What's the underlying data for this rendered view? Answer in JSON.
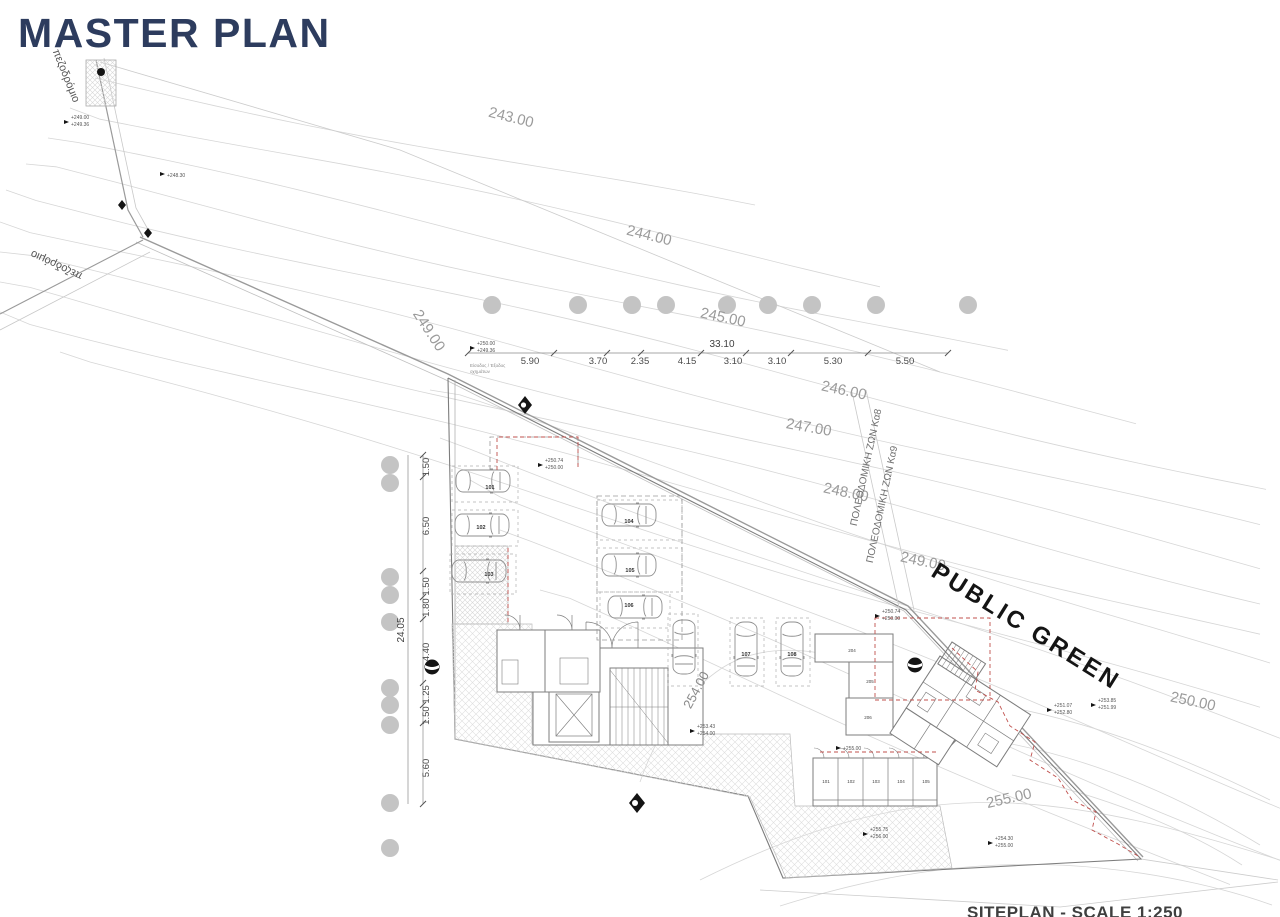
{
  "page": {
    "title": "MASTER PLAN",
    "caption": "SITEPLAN - SCALE 1:250"
  },
  "colors": {
    "title_navy": "#2d3c5e",
    "contour_gray": "#d6d6d6",
    "drawing_gray": "#7d7d7d",
    "label_gray": "#9b9b9b",
    "red_accent": "#c0504d",
    "ink_black": "#141414",
    "tree_gray": "#c4c4c4"
  },
  "labels": {
    "public_green": "PUBLIC GREEN",
    "sidewalk_top": "πεζοδρόμιο",
    "sidewalk_left": "πεζοδρόμιο",
    "zone_line_1": "ΠΟΛΕΟΔΟΜΙΚΗ ΖΩΝ Κα8",
    "zone_line_2": "ΠΟΛΕΟΔΟΜΙΚΗ ΖΩΝ Κα9"
  },
  "contour_labels": {
    "c243": "243.00",
    "c244": "244.00",
    "c245": "245.00",
    "c246": "246.00",
    "c247": "247.00",
    "c248": "248.00",
    "c249_left": "249.00",
    "c249_right": "249.00",
    "c250": "250.00",
    "c254": "254.00",
    "c255": "255.00"
  },
  "dimensions": {
    "top_total": "33.10",
    "top_segments": [
      "5.90",
      "3.70",
      "2.35",
      "4.15",
      "3.10",
      "3.10",
      "5.30",
      "5.50"
    ],
    "left_total": "24.05",
    "left_segments": [
      "1.50",
      "6.50",
      "1.80 1.50",
      "4.40",
      "1.50 1.25",
      "5.60"
    ]
  },
  "notes": {
    "entrance_1": "Είσοδος / Έξοδος",
    "entrance_2": "οχημάτων"
  },
  "spot_levels": [
    {
      "a": "+249.00",
      "b": "+249.36"
    },
    {
      "a": "+248.30",
      "b": ""
    },
    {
      "a": "+250.00",
      "b": "+249.36"
    },
    {
      "a": "+250.74",
      "b": "+250.00"
    },
    {
      "a": "+250.74",
      "b": "+250.00"
    },
    {
      "a": "+253.43",
      "b": "+254.00"
    },
    {
      "a": "+251.07",
      "b": "+252.80"
    },
    {
      "a": "+253.85",
      "b": "+251.99"
    },
    {
      "a": "+255.75",
      "b": "+256.00"
    },
    {
      "a": "+254.30",
      "b": "+255.00"
    },
    {
      "a": "+255.00",
      "b": ""
    }
  ],
  "parking_numbers": [
    "101",
    "102",
    "103",
    "104",
    "105",
    "106",
    "107",
    "108"
  ],
  "room_numbers": [
    "204",
    "205",
    "206"
  ],
  "storage_numbers": [
    "101",
    "102",
    "103",
    "104",
    "105"
  ]
}
